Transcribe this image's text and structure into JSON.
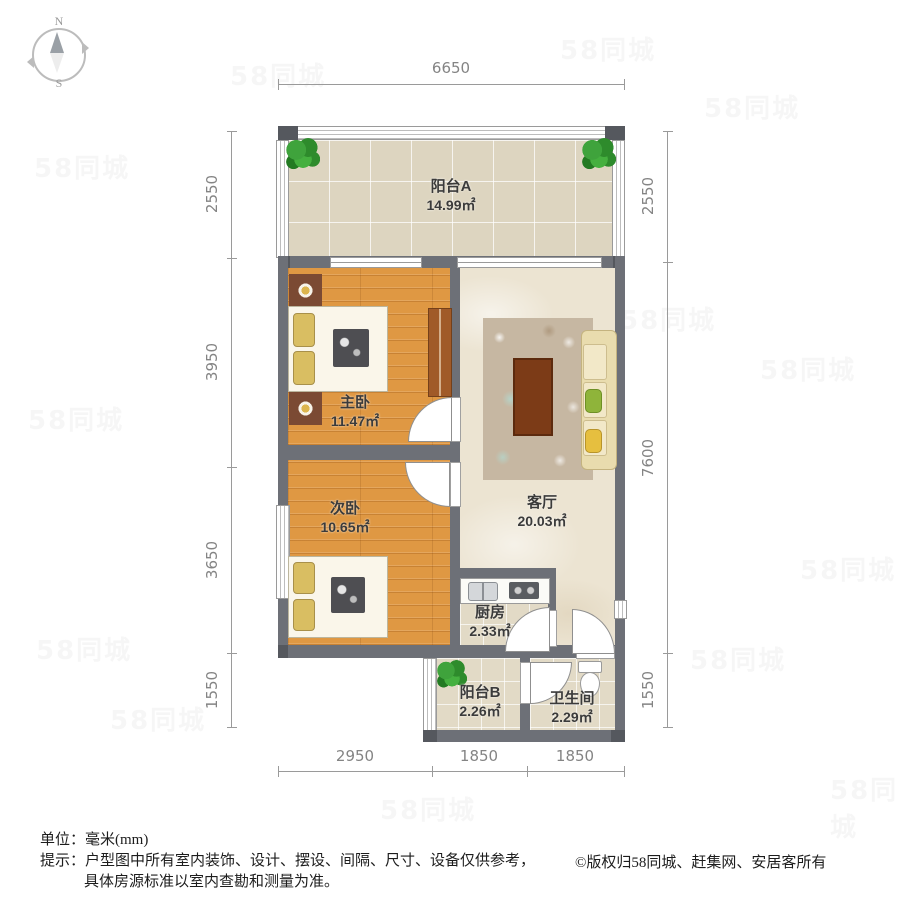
{
  "compass": {
    "north": "N",
    "south": "S"
  },
  "watermark": {
    "text": "58同城"
  },
  "colors": {
    "wall": "#6d7077",
    "wall_dark": "#55585e",
    "wood_floor": "#df9843",
    "balcony_tile": "#ddd5c0",
    "living_floor": "#ece4d2",
    "small_tile": "#e2dac6",
    "plant_green": "#3fa33c",
    "dimension_text": "#848484",
    "label_text": "#3b3b3b"
  },
  "rooms": [
    {
      "name": "阳台A",
      "area": "14.99㎡"
    },
    {
      "name": "主卧",
      "area": "11.47㎡"
    },
    {
      "name": "次卧",
      "area": "10.65㎡"
    },
    {
      "name": "客厅",
      "area": "20.03㎡"
    },
    {
      "name": "厨房",
      "area": "2.33㎡"
    },
    {
      "name": "阳台B",
      "area": "2.26㎡"
    },
    {
      "name": "卫生间",
      "area": "2.29㎡"
    }
  ],
  "dimensions": {
    "top": [
      {
        "label": "6650"
      }
    ],
    "left": [
      {
        "label": "2550"
      },
      {
        "label": "3950"
      },
      {
        "label": "3650"
      },
      {
        "label": "1550"
      }
    ],
    "right": [
      {
        "label": "2550"
      },
      {
        "label": "7600"
      },
      {
        "label": "1550"
      }
    ],
    "bottom": [
      {
        "label": "2950"
      },
      {
        "label": "1850"
      },
      {
        "label": "1850"
      }
    ]
  },
  "footer": {
    "unit_label": "单位：",
    "unit_value": "毫米(mm)",
    "tip_label": "提示：",
    "tip_line1": "户型图中所有室内装饰、设计、摆设、间隔、尺寸、设备仅供参考，",
    "tip_line2": "具体房源标准以室内查勘和测量为准。",
    "copyright": "©版权归58同城、赶集网、安居客所有"
  }
}
